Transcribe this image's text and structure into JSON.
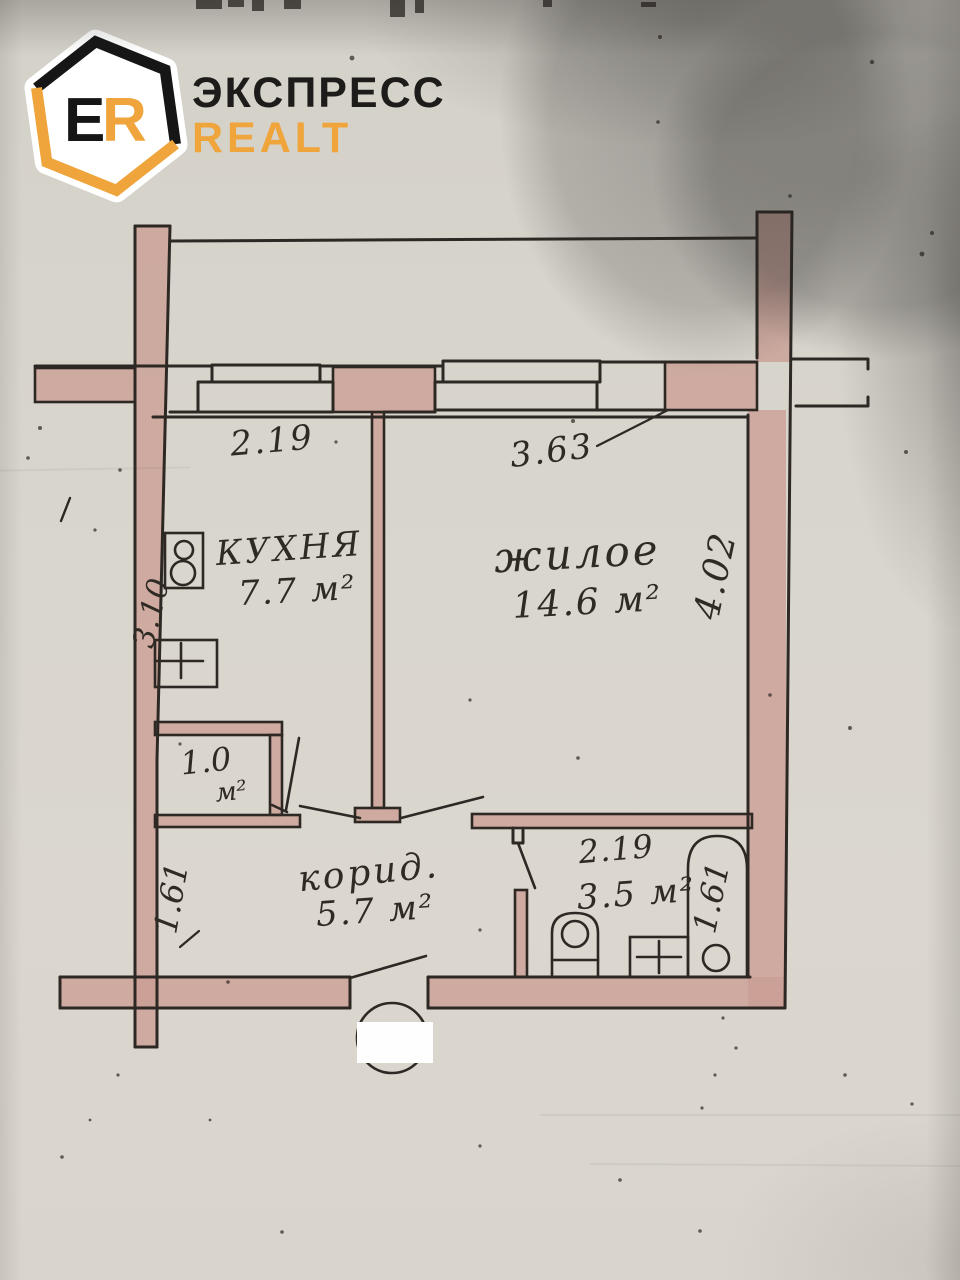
{
  "brand": {
    "monogram_e": "E",
    "monogram_r": "R",
    "line1": "ЭКСПРЕСС",
    "line2": "REALT"
  },
  "labels": {
    "kitchen_name": "КУХНЯ",
    "kitchen_area": "7.7 м²",
    "kitchen_width": "2.19",
    "kitchen_depth": "3.10",
    "living_name": "жилое",
    "living_area": "14.6 м²",
    "living_width": "3.63",
    "living_depth": "4.02",
    "closet_area_value": "1.0",
    "closet_area_unit": "м²",
    "corridor_name": "корид.",
    "corridor_area": "5.7 м²",
    "corridor_depth": "1.61",
    "bathroom_width": "2.19",
    "bathroom_area": "3.5 м²",
    "bathroom_depth": "1.61"
  },
  "colors": {
    "accent": "#EFA43C",
    "ink": "#2D2823",
    "wall_fill": "#CB9E93",
    "paper": "#D8D5CD"
  }
}
